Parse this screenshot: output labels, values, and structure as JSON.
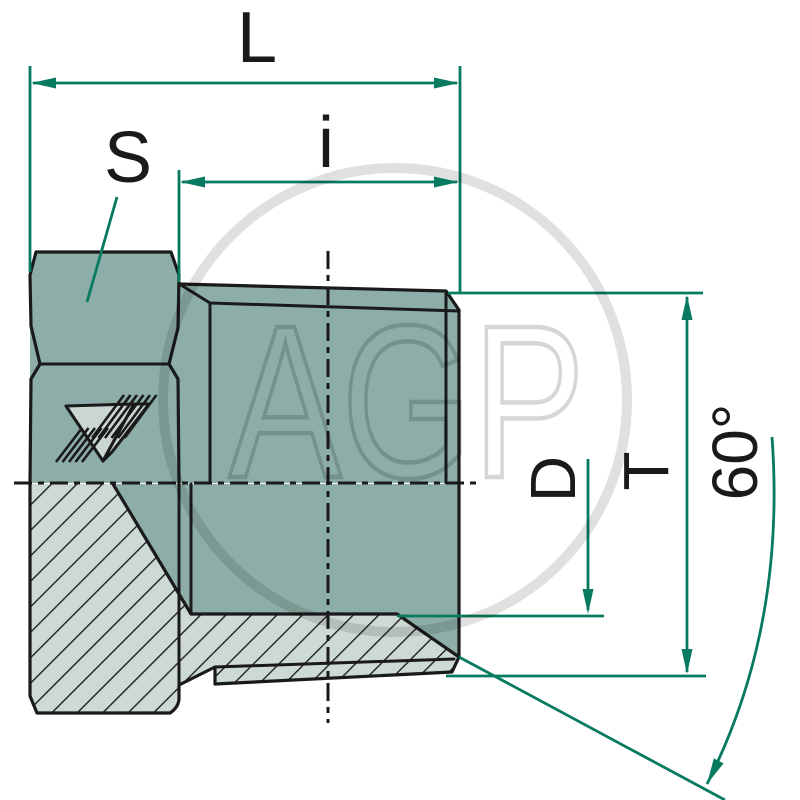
{
  "drawing": {
    "labels": {
      "overall_length": "L",
      "thread_length": "i",
      "hex_size": "S",
      "thread_diameter": "D",
      "outer_diameter": "T",
      "cone_angle": "60°"
    },
    "watermark": "AGP",
    "colors": {
      "body_fill": "#8CADA8",
      "section_fill": "#CCD9D5",
      "outline": "#1A1A1A",
      "dimension_green": "#087A5F"
    }
  }
}
